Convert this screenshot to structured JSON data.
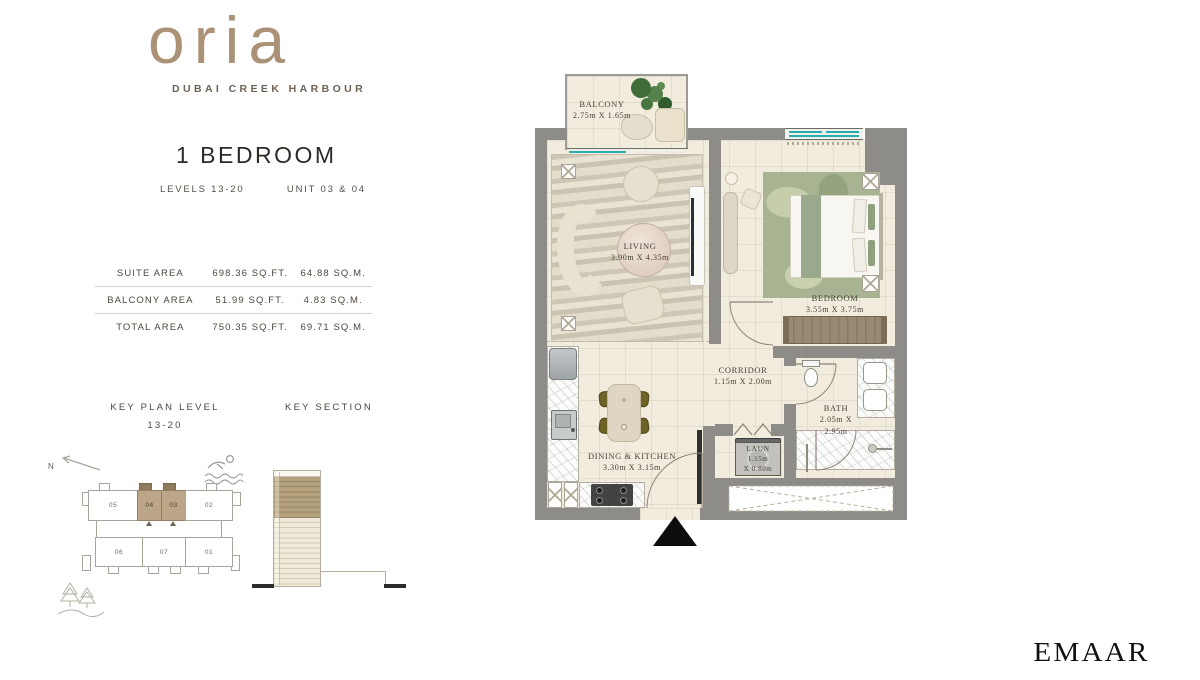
{
  "brand": {
    "logo_text": "oria",
    "tagline": "DUBAI CREEK HARBOUR",
    "developer": "EMAAR"
  },
  "unit": {
    "title": "1 BEDROOM",
    "levels_label": "LEVELS 13-20",
    "units_label": "UNIT 03 & 04"
  },
  "areas": {
    "rows": [
      {
        "label": "SUITE AREA",
        "sqft": "698.36 SQ.FT.",
        "sqm": "64.88 SQ.M."
      },
      {
        "label": "BALCONY AREA",
        "sqft": "51.99 SQ.FT.",
        "sqm": "4.83 SQ.M."
      },
      {
        "label": "TOTAL AREA",
        "sqft": "750.35 SQ.FT.",
        "sqm": "69.71 SQ.M."
      }
    ]
  },
  "key_plan": {
    "title": "KEY PLAN LEVEL",
    "range": "13-20",
    "north_label": "N",
    "units_top": [
      "05",
      "04",
      "03",
      "02"
    ],
    "units_bottom": [
      "06",
      "07",
      "01"
    ],
    "highlighted_units": [
      "04",
      "03"
    ]
  },
  "key_section": {
    "title": "KEY SECTION"
  },
  "floor_plan": {
    "rooms": {
      "balcony": {
        "name": "BALCONY",
        "dims": "2.75m X 1.65m"
      },
      "living": {
        "name": "LIVING",
        "dims": "3.90m X 4.35m"
      },
      "bedroom": {
        "name": "BEDROOM",
        "dims": "3.55m X 3.75m"
      },
      "corridor": {
        "name": "CORRIDOR",
        "dims": "1.15m X 2.00m"
      },
      "bath": {
        "name": "BATH",
        "dims1": "2.05m X",
        "dims2": "2.95m"
      },
      "laundry": {
        "name": "LAUN",
        "dims1": "1.15m",
        "dims2": "X 0.80m"
      },
      "dining": {
        "name": "DINING & KITCHEN",
        "dims": "3.30m X 3.15m"
      }
    }
  },
  "colors": {
    "wall_gray": "#8e8c88",
    "floor_cream": "#f2ecdf",
    "window_teal": "#29aeab",
    "highlight_tan": "#bba687",
    "rug_green": "#a8b392",
    "wardrobe_brown": "#9b8a73",
    "logo_tan": "#ab9276",
    "text_dark": "#2e2b26"
  }
}
